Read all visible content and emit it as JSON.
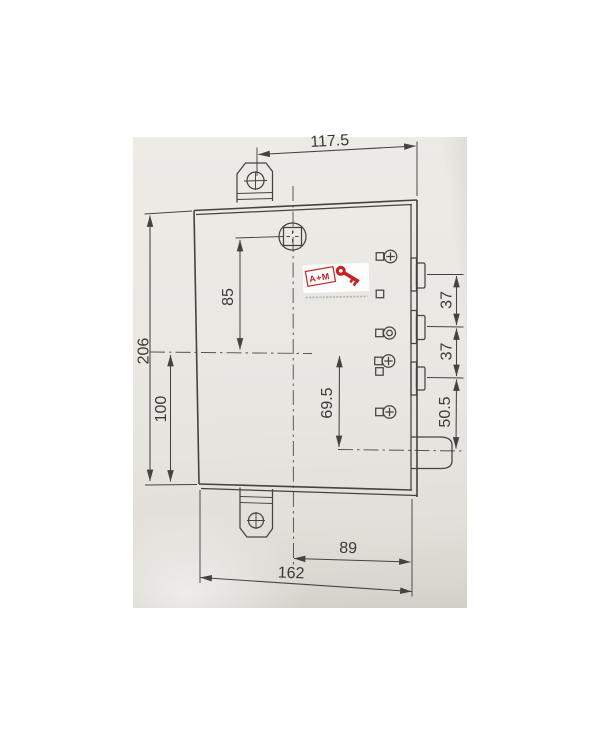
{
  "drawing": {
    "subject": "mortise door lock case technical drawing with mounting tabs, three deadbolts and latch",
    "colors": {
      "paper": "#e8e6e1",
      "line": "#45433f",
      "background": "#ffffff",
      "logo_red": "#c62222"
    }
  },
  "dims": {
    "tab_to_right_edge": "117.5",
    "case_height": "206",
    "centerline_to_bottom": "100",
    "spindle_to_centerline": "85",
    "centerline_to_latch": "69.5",
    "bolt_gap_top": "37",
    "bolt_gap_bottom": "37",
    "bolt_to_latch": "50.5",
    "centerline_to_right": "89",
    "case_width": "162"
  },
  "logo": {
    "text": "A+M"
  }
}
